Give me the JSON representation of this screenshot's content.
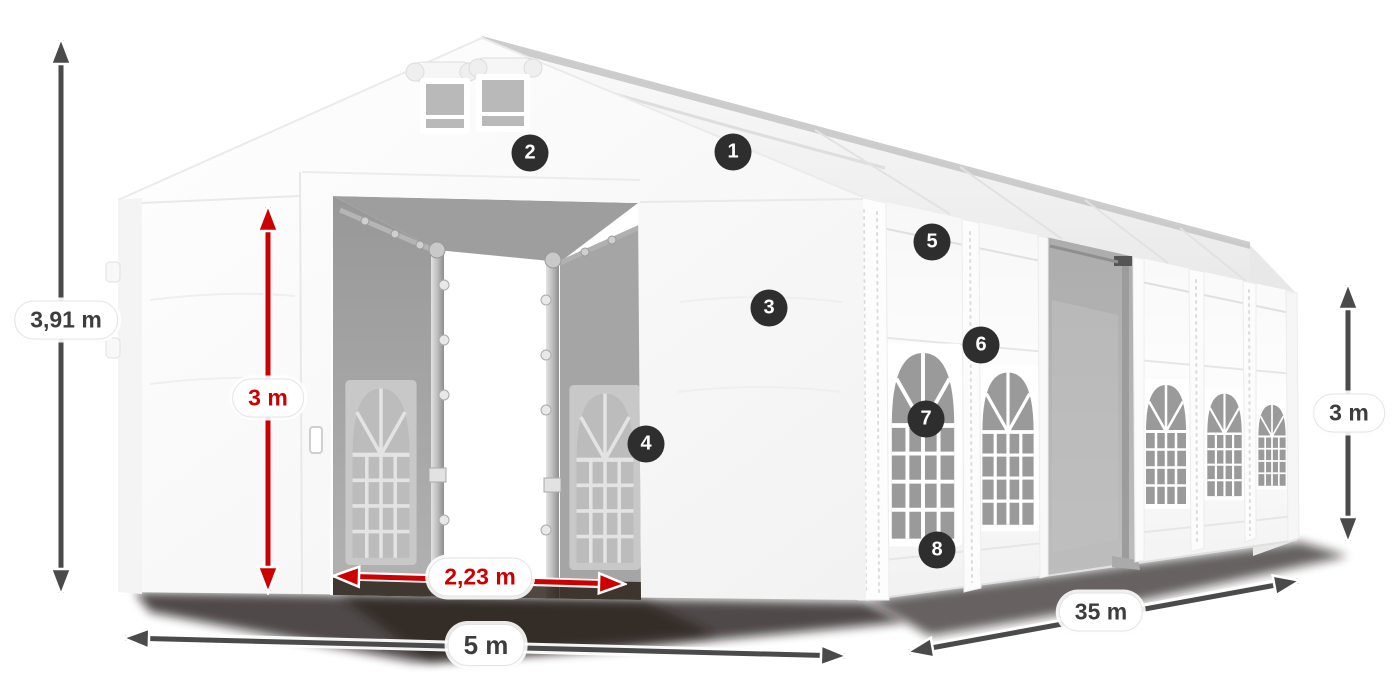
{
  "colors": {
    "red": "#cc0000",
    "arrow": "#4a4a4a",
    "badge": "#2e2e2e",
    "label": "#3d3d3d"
  },
  "dimensions": {
    "total_height": {
      "label": "3,91 m",
      "style": "dark"
    },
    "door_height": {
      "label": "3 m",
      "style": "red"
    },
    "door_width": {
      "label": "2,23 m",
      "style": "red"
    },
    "front_width": {
      "label": "5 m",
      "style": "dark"
    },
    "side_length": {
      "label": "35 m",
      "style": "dark"
    },
    "side_height": {
      "label": "3 m",
      "style": "dark"
    }
  },
  "callouts": [
    {
      "number": "1"
    },
    {
      "number": "2"
    },
    {
      "number": "3"
    },
    {
      "number": "4"
    },
    {
      "number": "5"
    },
    {
      "number": "6"
    },
    {
      "number": "7"
    },
    {
      "number": "8"
    }
  ]
}
